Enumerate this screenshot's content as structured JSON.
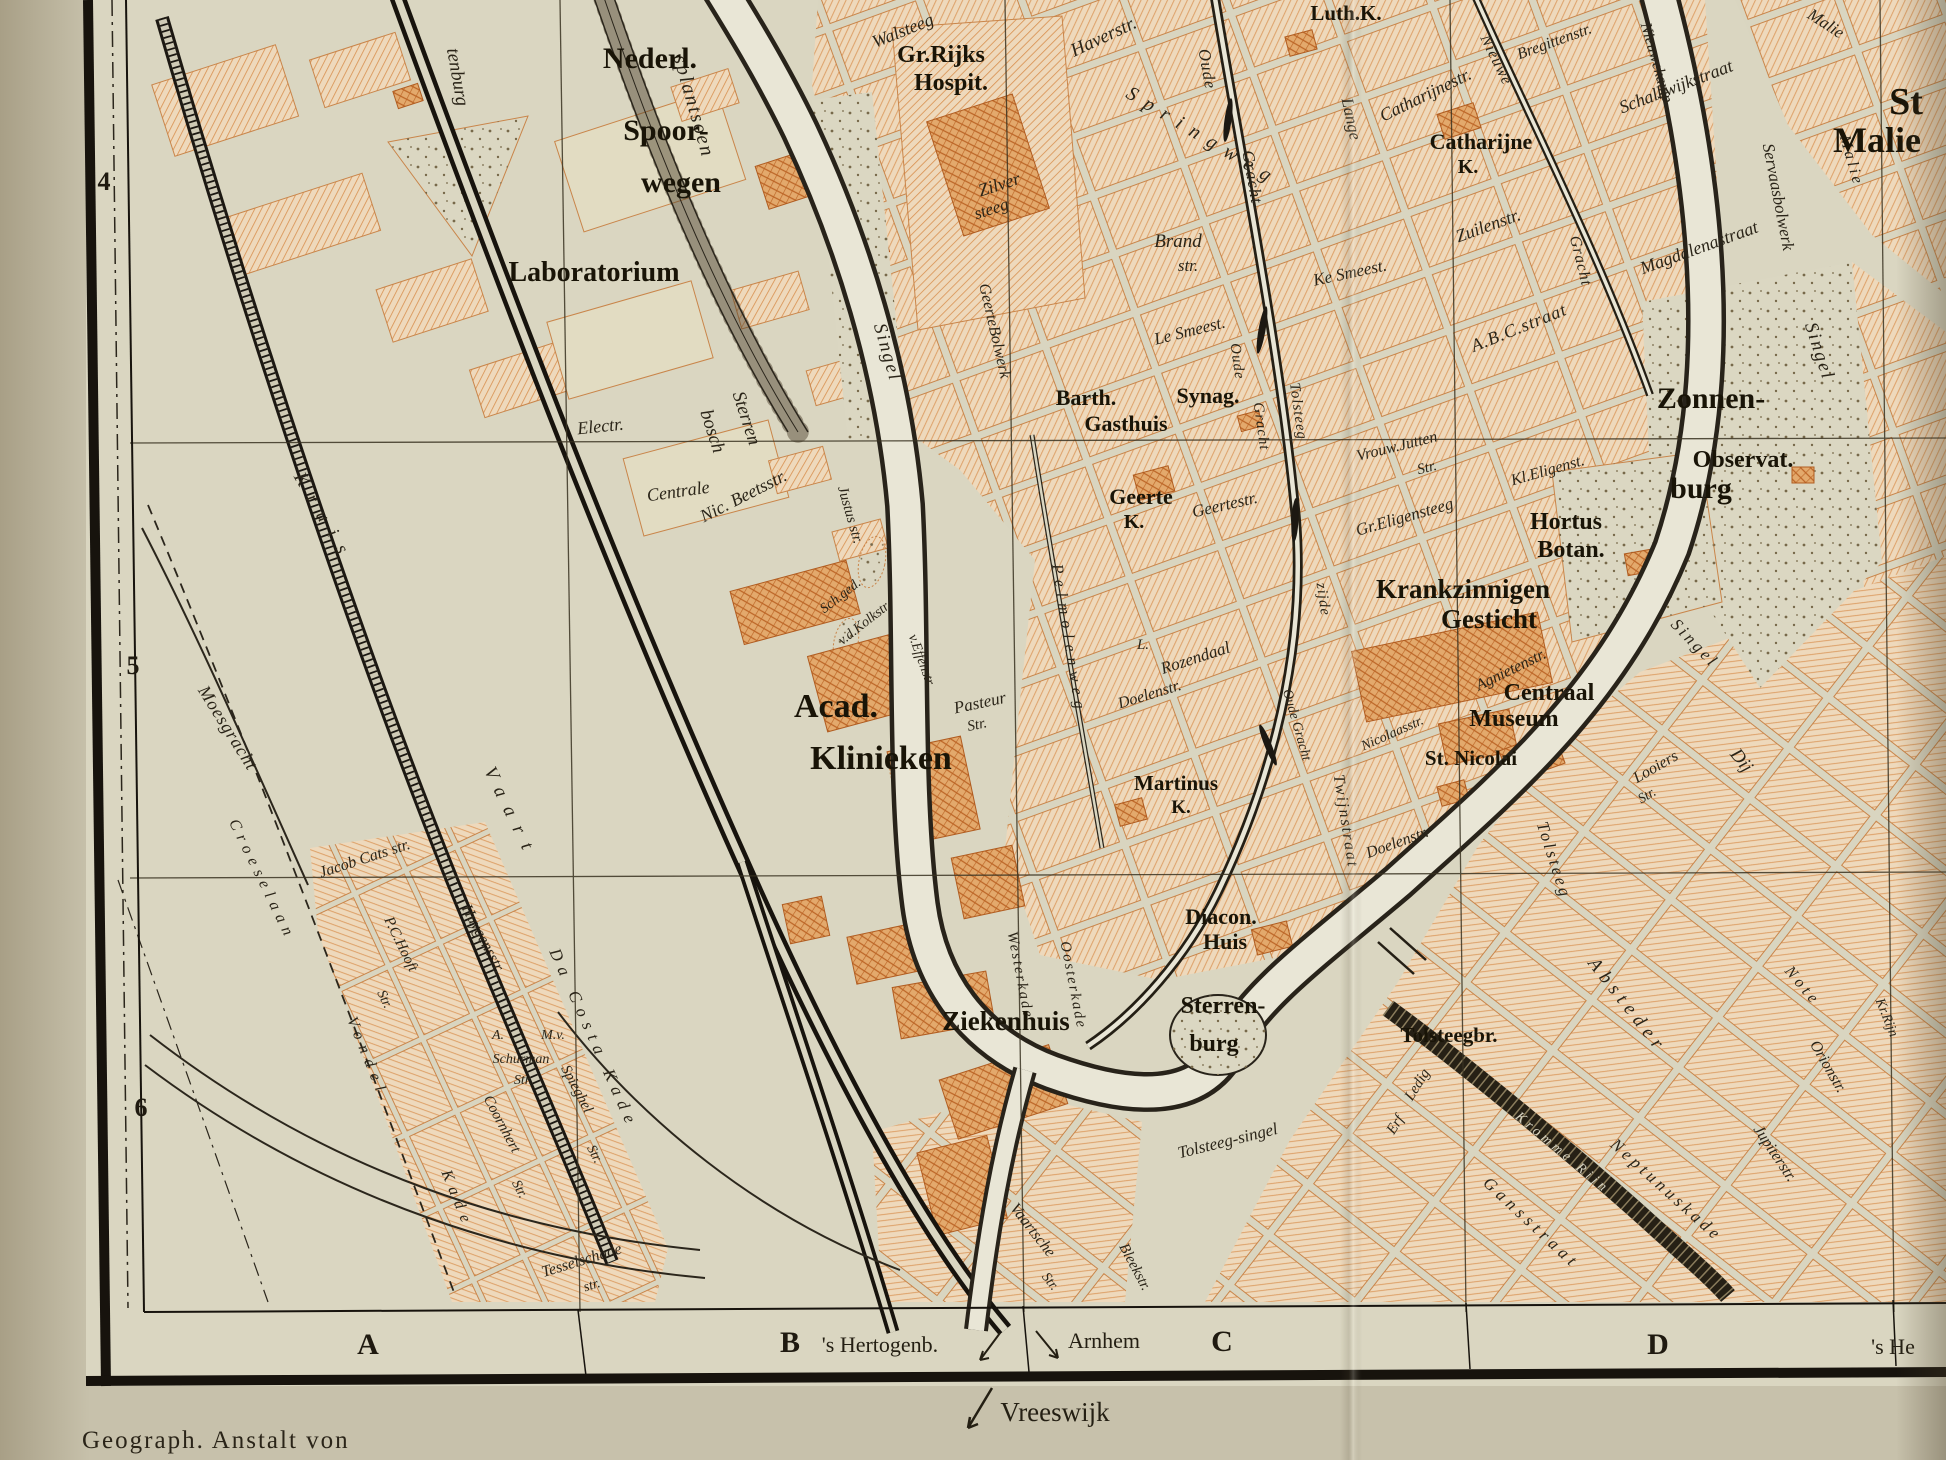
{
  "caption": "Geograph. Anstalt von",
  "colors": {
    "paper": "#c7c1ab",
    "map_background": "#dad6c1",
    "block_fill": "#eed9bc",
    "block_hatch": "#d8904f",
    "building_fill": "#e3a96c",
    "building_hatch": "#bc6526",
    "ink": "#221d12",
    "water": "#e9e6d6"
  },
  "grid": {
    "rows": [
      {
        "t": "4",
        "x": 104,
        "y": 190,
        "s": 26
      },
      {
        "t": "5",
        "x": 133,
        "y": 674,
        "s": 26
      },
      {
        "t": "6",
        "x": 141,
        "y": 1116,
        "s": 26
      }
    ],
    "cols": [
      {
        "t": "A",
        "x": 368,
        "y": 1354,
        "s": 30
      },
      {
        "t": "B",
        "x": 790,
        "y": 1352,
        "s": 30
      },
      {
        "t": "C",
        "x": 1222,
        "y": 1351,
        "s": 30
      },
      {
        "t": "D",
        "x": 1658,
        "y": 1354,
        "s": 30
      }
    ]
  },
  "directions": [
    {
      "t": "'s Hertogenb.",
      "x": 880,
      "y": 1352,
      "s": 22
    },
    {
      "t": "Arnhem",
      "x": 1104,
      "y": 1348,
      "s": 22
    },
    {
      "t": "'s He",
      "x": 1893,
      "y": 1354,
      "s": 22
    },
    {
      "t": "Vreeswijk",
      "x": 1055,
      "y": 1421,
      "s": 27
    }
  ],
  "labels": {
    "streets": [
      {
        "t": "tenburg",
        "x": 452,
        "y": 78,
        "r": 80,
        "s": 19
      },
      {
        "t": "splantsoen",
        "x": 688,
        "y": 108,
        "r": 74,
        "s": 20,
        "ls": 2
      },
      {
        "t": "Walsteeg",
        "x": 905,
        "y": 36,
        "r": -22,
        "s": 18
      },
      {
        "t": "Haverstr.",
        "x": 1106,
        "y": 42,
        "r": -25,
        "s": 19
      },
      {
        "t": "Springweg",
        "x": 1200,
        "y": 142,
        "r": 31,
        "s": 20,
        "ls": 10
      },
      {
        "t": "Zilver",
        "x": 1001,
        "y": 190,
        "r": -18,
        "s": 18
      },
      {
        "t": "steeg",
        "x": 993,
        "y": 214,
        "r": -18,
        "s": 17
      },
      {
        "t": "GeerteBolwerk",
        "x": 990,
        "y": 332,
        "r": 77,
        "s": 16
      },
      {
        "t": "Singel",
        "x": 882,
        "y": 354,
        "r": 74,
        "s": 19,
        "ls": 2
      },
      {
        "t": "Oude",
        "x": 1202,
        "y": 70,
        "r": 80,
        "s": 17,
        "ls": 1
      },
      {
        "t": "Gracht",
        "x": 1247,
        "y": 178,
        "r": 80,
        "s": 17,
        "ls": 1
      },
      {
        "t": "Lange",
        "x": 1346,
        "y": 120,
        "r": 78,
        "s": 17
      },
      {
        "t": "Catharijnestr.",
        "x": 1428,
        "y": 100,
        "r": -26,
        "s": 18
      },
      {
        "t": "Nieuwe",
        "x": 1492,
        "y": 62,
        "r": 64,
        "s": 16,
        "ls": 1
      },
      {
        "t": "Gracht",
        "x": 1576,
        "y": 262,
        "r": 76,
        "s": 16,
        "ls": 1
      },
      {
        "t": "Bregittenstr.",
        "x": 1556,
        "y": 46,
        "r": -20,
        "s": 16
      },
      {
        "t": "Nieuwekamp",
        "x": 1652,
        "y": 64,
        "r": 74,
        "s": 16
      },
      {
        "t": "Schalkwijkstraat",
        "x": 1678,
        "y": 92,
        "r": -21,
        "s": 18
      },
      {
        "t": "Servaasbolwerk",
        "x": 1773,
        "y": 198,
        "r": 79,
        "s": 17
      },
      {
        "t": "Magdalenastraat",
        "x": 1701,
        "y": 253,
        "r": -20,
        "s": 18
      },
      {
        "t": "A.B.C.straat",
        "x": 1521,
        "y": 333,
        "r": -22,
        "s": 18,
        "ls": 1
      },
      {
        "t": "Zuilenstr.",
        "x": 1490,
        "y": 231,
        "r": -20,
        "s": 18
      },
      {
        "t": "Ke Smeest.",
        "x": 1351,
        "y": 278,
        "r": -12,
        "s": 17
      },
      {
        "t": "Le Smeest.",
        "x": 1191,
        "y": 336,
        "r": -14,
        "s": 17
      },
      {
        "t": "Brand",
        "x": 1178,
        "y": 247,
        "s": 19
      },
      {
        "t": "str.",
        "x": 1188,
        "y": 271,
        "s": 17
      },
      {
        "t": "Malie",
        "x": 1823,
        "y": 28,
        "r": 33,
        "s": 17
      },
      {
        "t": "Malie",
        "x": 1847,
        "y": 162,
        "r": 74,
        "s": 16,
        "ls": 3
      },
      {
        "t": "Singel",
        "x": 1814,
        "y": 353,
        "r": 72,
        "s": 19,
        "ls": 2
      },
      {
        "t": "Electr.",
        "x": 601,
        "y": 432,
        "r": -6,
        "s": 18
      },
      {
        "t": "Centrale",
        "x": 679,
        "y": 497,
        "r": -8,
        "s": 18
      },
      {
        "t": "Sterren",
        "x": 741,
        "y": 420,
        "r": 72,
        "s": 19
      },
      {
        "t": "bosch",
        "x": 707,
        "y": 433,
        "r": 72,
        "s": 19
      },
      {
        "t": "Nic. Beetsstr.",
        "x": 746,
        "y": 501,
        "r": -27,
        "s": 18
      },
      {
        "t": "Justus str.",
        "x": 846,
        "y": 516,
        "r": 74,
        "s": 15
      },
      {
        "t": "Sch.ged.",
        "x": 843,
        "y": 599,
        "r": -38,
        "s": 14
      },
      {
        "t": "v.d.Kolkstr.",
        "x": 867,
        "y": 626,
        "r": -38,
        "s": 14
      },
      {
        "t": "v.Effenstr.",
        "x": 918,
        "y": 662,
        "r": 70,
        "s": 14
      },
      {
        "t": "Pasteur",
        "x": 981,
        "y": 708,
        "r": -12,
        "s": 17
      },
      {
        "t": "Str.",
        "x": 978,
        "y": 729,
        "r": -12,
        "s": 15
      },
      {
        "t": "Pelmolenweg",
        "x": 1064,
        "y": 640,
        "r": 81,
        "s": 16,
        "ls": 6
      },
      {
        "t": "Geertestr.",
        "x": 1226,
        "y": 510,
        "r": -13,
        "s": 17
      },
      {
        "t": "Vrouw.Jutten",
        "x": 1398,
        "y": 451,
        "r": -14,
        "s": 16
      },
      {
        "t": "Str.",
        "x": 1428,
        "y": 472,
        "r": -14,
        "s": 15
      },
      {
        "t": "Gr.Eligensteeg",
        "x": 1406,
        "y": 522,
        "r": -16,
        "s": 17
      },
      {
        "t": "Kl.Eligenst.",
        "x": 1549,
        "y": 475,
        "r": -16,
        "s": 16
      },
      {
        "t": "Oude",
        "x": 1233,
        "y": 362,
        "r": 82,
        "s": 15,
        "ls": 1
      },
      {
        "t": "Gracht",
        "x": 1257,
        "y": 427,
        "r": 82,
        "s": 15,
        "ls": 1
      },
      {
        "t": "Tolsteeg",
        "x": 1294,
        "y": 412,
        "r": 82,
        "s": 15,
        "ls": 1
      },
      {
        "t": "zijde",
        "x": 1319,
        "y": 600,
        "r": 82,
        "s": 15,
        "ls": 1
      },
      {
        "t": "L.",
        "x": 1143,
        "y": 649,
        "s": 15
      },
      {
        "t": "Rozendaal",
        "x": 1197,
        "y": 663,
        "r": -18,
        "s": 17
      },
      {
        "t": "Twijnstraat",
        "x": 1341,
        "y": 822,
        "r": 81,
        "s": 16,
        "ls": 2
      },
      {
        "t": "Doelenstr.",
        "x": 1151,
        "y": 699,
        "r": -17,
        "s": 16
      },
      {
        "t": "Doelenstr.",
        "x": 1399,
        "y": 847,
        "r": -20,
        "s": 16
      },
      {
        "t": "Nicolaasstr.",
        "x": 1394,
        "y": 737,
        "r": -24,
        "s": 14
      },
      {
        "t": "Agnietenstr.",
        "x": 1513,
        "y": 674,
        "r": -26,
        "s": 16
      },
      {
        "t": "Oude Gracht",
        "x": 1293,
        "y": 726,
        "r": 74,
        "s": 14
      },
      {
        "t": "Tolsteeg",
        "x": 1549,
        "y": 862,
        "r": 72,
        "s": 17,
        "ls": 3
      },
      {
        "t": "Singel",
        "x": 1691,
        "y": 647,
        "r": 46,
        "s": 17,
        "ls": 3
      },
      {
        "t": "Looiers",
        "x": 1658,
        "y": 771,
        "r": -30,
        "s": 16
      },
      {
        "t": "Str.",
        "x": 1649,
        "y": 799,
        "r": -30,
        "s": 14
      },
      {
        "t": "Tolsteeg-singel",
        "x": 1229,
        "y": 1146,
        "r": -14,
        "s": 17
      },
      {
        "t": "Ledig",
        "x": 1421,
        "y": 1087,
        "r": -58,
        "s": 15
      },
      {
        "t": "Erf",
        "x": 1399,
        "y": 1127,
        "r": -58,
        "s": 15
      },
      {
        "t": "Gansstraat",
        "x": 1528,
        "y": 1227,
        "r": 43,
        "s": 17,
        "ls": 5
      },
      {
        "t": "Vaartsche",
        "x": 1029,
        "y": 1233,
        "r": 52,
        "s": 16
      },
      {
        "t": "Str.",
        "x": 1047,
        "y": 1284,
        "r": 52,
        "s": 14
      },
      {
        "t": "Bleekstr.",
        "x": 1131,
        "y": 1269,
        "r": 62,
        "s": 15
      },
      {
        "t": "Westerkade",
        "x": 1016,
        "y": 976,
        "r": 79,
        "s": 15,
        "ls": 2
      },
      {
        "t": "Oosterkade",
        "x": 1069,
        "y": 986,
        "r": 79,
        "s": 15,
        "ls": 2
      },
      {
        "t": "Neptunuskade",
        "x": 1663,
        "y": 1194,
        "r": 42,
        "s": 17,
        "ls": 4
      },
      {
        "t": "Jupiterstr.",
        "x": 1771,
        "y": 1156,
        "r": 56,
        "s": 16
      },
      {
        "t": "Orionstr.",
        "x": 1824,
        "y": 1069,
        "r": 60,
        "s": 16
      },
      {
        "t": "Absteder",
        "x": 1623,
        "y": 1009,
        "r": 52,
        "s": 19,
        "ls": 6
      },
      {
        "t": "Dij",
        "x": 1737,
        "y": 764,
        "r": 52,
        "s": 19
      },
      {
        "t": "Note",
        "x": 1799,
        "y": 989,
        "r": 50,
        "s": 16,
        "ls": 4
      },
      {
        "t": "Kr.Rijn",
        "x": 1883,
        "y": 1019,
        "r": 68,
        "s": 14
      },
      {
        "t": "Croeselaan",
        "x": 258,
        "y": 882,
        "r": 64,
        "s": 16,
        "ls": 6
      },
      {
        "t": "Moesgracht",
        "x": 223,
        "y": 731,
        "r": 58,
        "s": 18,
        "ls": 1
      },
      {
        "t": "Kruis",
        "x": 319,
        "y": 521,
        "r": 60,
        "s": 19,
        "ls": 12
      },
      {
        "t": "Vaart",
        "x": 506,
        "y": 816,
        "r": 64,
        "s": 19,
        "ls": 12
      },
      {
        "t": "Da Costa Kade",
        "x": 589,
        "y": 1041,
        "r": 66,
        "s": 17,
        "ls": 7
      },
      {
        "t": "Vondel",
        "x": 363,
        "y": 1059,
        "r": 68,
        "s": 16,
        "ls": 7
      },
      {
        "t": "Kade",
        "x": 453,
        "y": 1201,
        "r": 68,
        "s": 16,
        "ls": 7
      },
      {
        "t": "Jacob Cats str.",
        "x": 366,
        "y": 863,
        "r": -18,
        "s": 16
      },
      {
        "t": "Huygensstr.",
        "x": 479,
        "y": 941,
        "r": 62,
        "s": 16
      },
      {
        "t": "P.C.Hooft",
        "x": 397,
        "y": 946,
        "r": 64,
        "s": 15
      },
      {
        "t": "Str.",
        "x": 381,
        "y": 1001,
        "r": 64,
        "s": 14
      },
      {
        "t": "A.",
        "x": 498,
        "y": 1039,
        "s": 14
      },
      {
        "t": "M.v.",
        "x": 553,
        "y": 1039,
        "s": 14
      },
      {
        "t": "Schurman",
        "x": 521,
        "y": 1063,
        "s": 14
      },
      {
        "t": "Str.",
        "x": 523,
        "y": 1084,
        "s": 14
      },
      {
        "t": "Spieghel",
        "x": 573,
        "y": 1091,
        "r": 62,
        "s": 15
      },
      {
        "t": "Str.",
        "x": 591,
        "y": 1156,
        "r": 62,
        "s": 14
      },
      {
        "t": "Coornhert",
        "x": 498,
        "y": 1126,
        "r": 62,
        "s": 15
      },
      {
        "t": "Str.",
        "x": 516,
        "y": 1191,
        "r": 62,
        "s": 14
      },
      {
        "t": "Tesselschade",
        "x": 583,
        "y": 1265,
        "r": -17,
        "s": 16
      },
      {
        "t": "str.",
        "x": 593,
        "y": 1289,
        "r": -17,
        "s": 14
      }
    ],
    "places": [
      {
        "t": "Nederl.",
        "x": 650,
        "y": 68,
        "s": 30
      },
      {
        "t": "Spoor-",
        "x": 666,
        "y": 140,
        "s": 30
      },
      {
        "t": "wegen",
        "x": 681,
        "y": 192,
        "s": 30
      },
      {
        "t": "Gr.Rijks",
        "x": 941,
        "y": 62,
        "s": 24
      },
      {
        "t": "Hospit.",
        "x": 951,
        "y": 90,
        "s": 24
      },
      {
        "t": "Luth.K.",
        "x": 1346,
        "y": 20,
        "s": 21
      },
      {
        "t": "Catharijne",
        "x": 1481,
        "y": 149,
        "s": 22
      },
      {
        "t": "K.",
        "x": 1468,
        "y": 173,
        "s": 20
      },
      {
        "t": "St",
        "x": 1906,
        "y": 114,
        "s": 38
      },
      {
        "t": "Malie",
        "x": 1877,
        "y": 152,
        "s": 36
      },
      {
        "t": "Laboratorium",
        "x": 594,
        "y": 281,
        "s": 28
      },
      {
        "t": "Barth.",
        "x": 1086,
        "y": 405,
        "s": 22
      },
      {
        "t": "Synag.",
        "x": 1208,
        "y": 403,
        "s": 22
      },
      {
        "t": "Gasthuis",
        "x": 1126,
        "y": 431,
        "s": 22
      },
      {
        "t": "Geerte",
        "x": 1141,
        "y": 504,
        "s": 22
      },
      {
        "t": "K.",
        "x": 1134,
        "y": 528,
        "s": 20
      },
      {
        "t": "Zonnen-",
        "x": 1711,
        "y": 408,
        "s": 30
      },
      {
        "t": "Observat.",
        "x": 1743,
        "y": 467,
        "s": 24
      },
      {
        "t": "burg",
        "x": 1701,
        "y": 498,
        "s": 30
      },
      {
        "t": "Hortus",
        "x": 1566,
        "y": 529,
        "s": 24
      },
      {
        "t": "Botan.",
        "x": 1571,
        "y": 557,
        "s": 24
      },
      {
        "t": "Krankzinnigen",
        "x": 1463,
        "y": 598,
        "s": 27
      },
      {
        "t": "Gesticht",
        "x": 1489,
        "y": 628,
        "s": 27
      },
      {
        "t": "Centraal",
        "x": 1549,
        "y": 700,
        "s": 24
      },
      {
        "t": "Museum",
        "x": 1514,
        "y": 726,
        "s": 24
      },
      {
        "t": "St. Nicolai",
        "x": 1471,
        "y": 765,
        "s": 21
      },
      {
        "t": "Acad.",
        "x": 836,
        "y": 717,
        "s": 34
      },
      {
        "t": "Klinieken",
        "x": 881,
        "y": 769,
        "s": 34
      },
      {
        "t": "Martinus",
        "x": 1176,
        "y": 790,
        "s": 21
      },
      {
        "t": "K.",
        "x": 1181,
        "y": 813,
        "s": 19
      },
      {
        "t": "Diacon.",
        "x": 1221,
        "y": 924,
        "s": 22
      },
      {
        "t": "Huis",
        "x": 1225,
        "y": 949,
        "s": 22
      },
      {
        "t": "Sterren-",
        "x": 1223,
        "y": 1013,
        "s": 24
      },
      {
        "t": "burg",
        "x": 1214,
        "y": 1051,
        "s": 24
      },
      {
        "t": "Ziekenhuis",
        "x": 1006,
        "y": 1030,
        "s": 27
      },
      {
        "t": "Tolsteegbr.",
        "x": 1449,
        "y": 1042,
        "s": 21
      }
    ],
    "water": [
      {
        "t": "Kromme Rijn",
        "x": 1560,
        "y": 1156,
        "r": 40,
        "s": 14,
        "ls": 4
      }
    ]
  }
}
